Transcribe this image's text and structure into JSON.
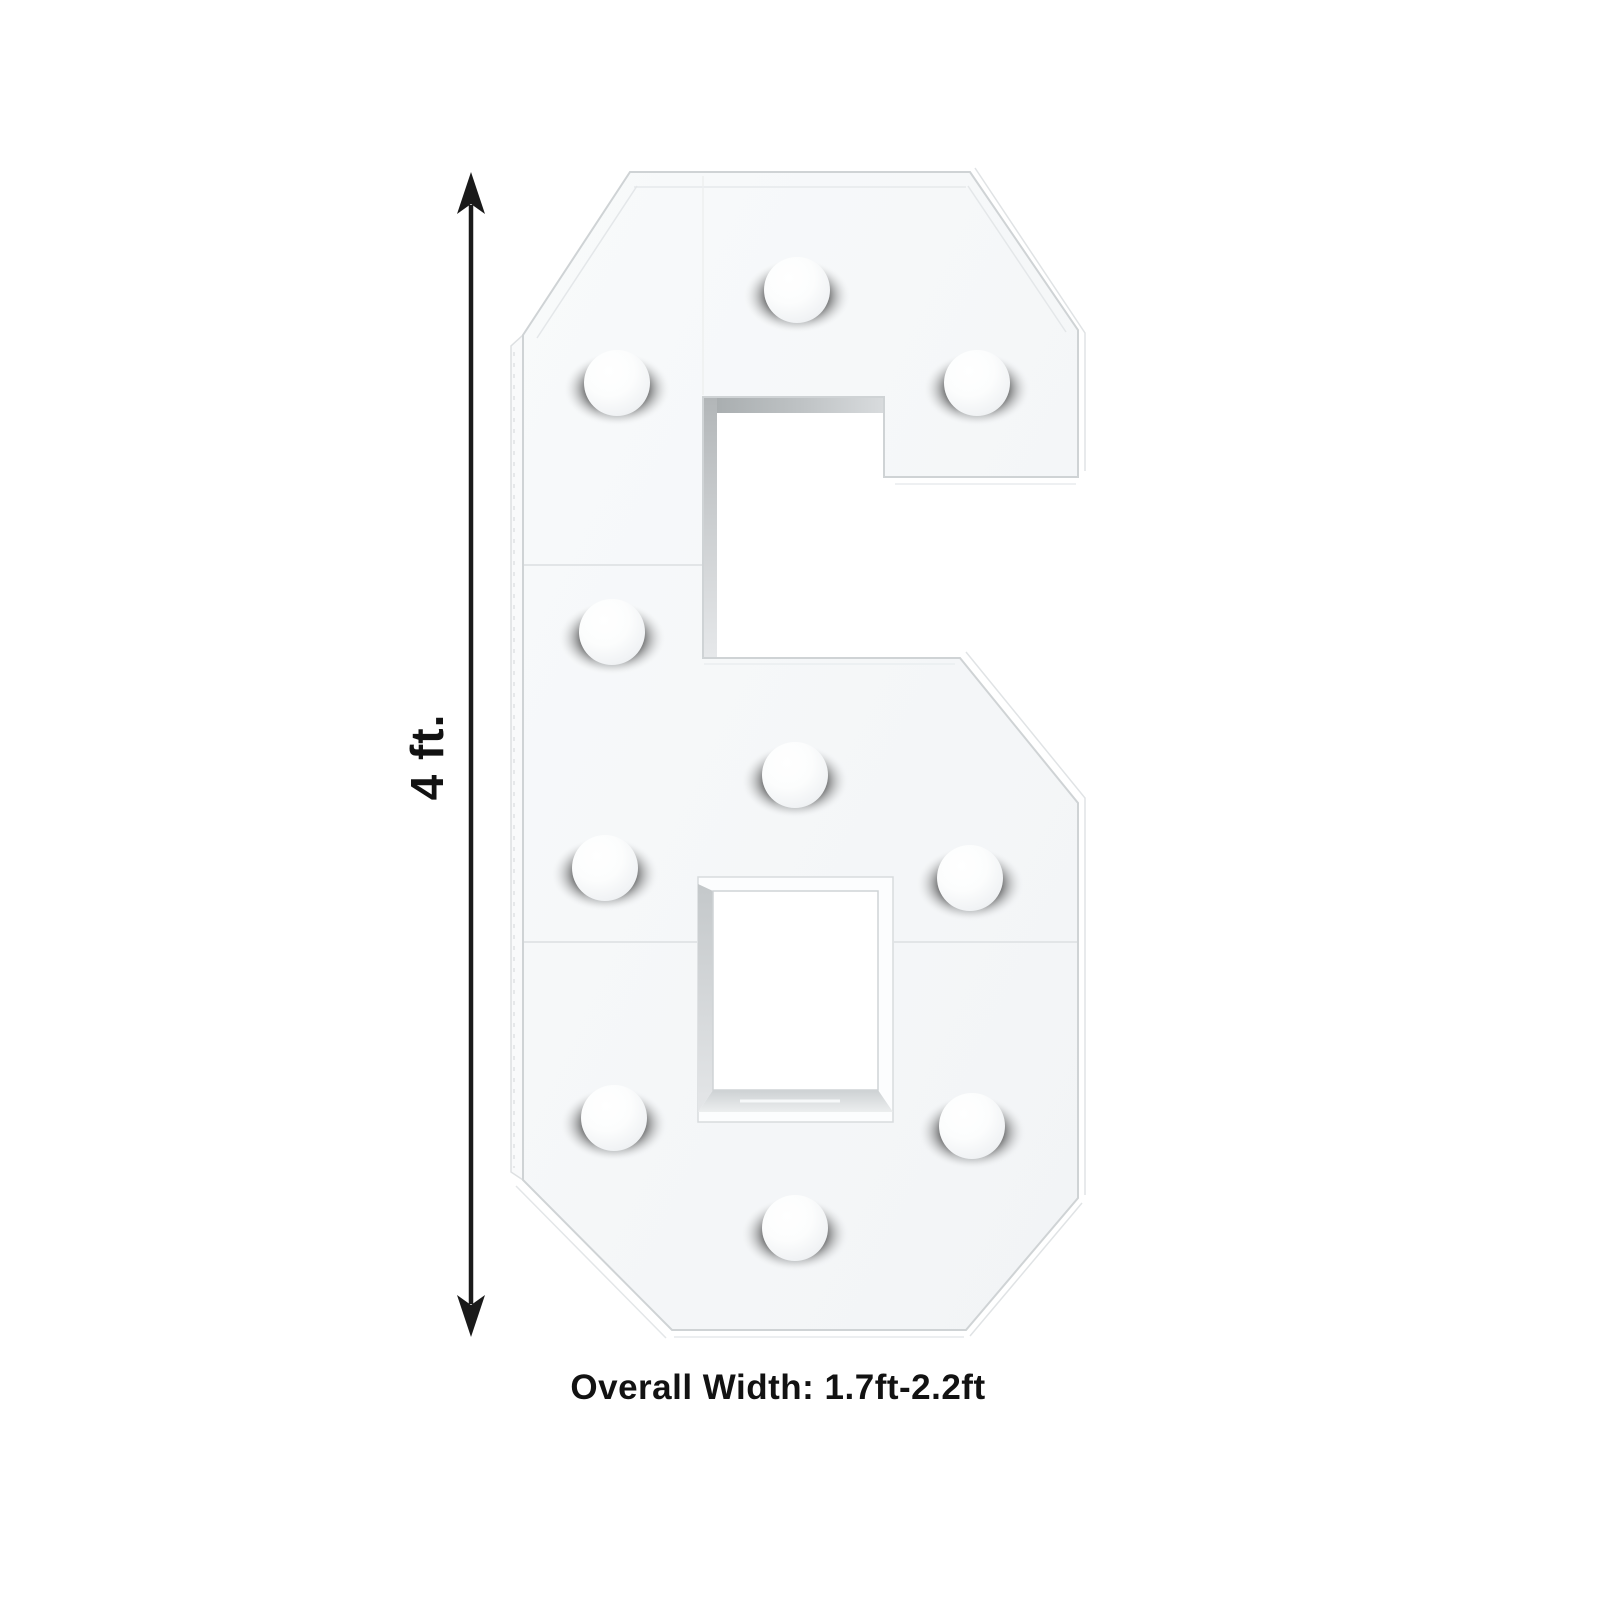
{
  "product_figure": {
    "character": "6",
    "kind": "marquee light-up number frame",
    "bulb_count": 10
  },
  "annotations": {
    "height_label": "4 ft.",
    "width_label": "Overall Width: 1.7ft-2.2ft"
  },
  "colors": {
    "background": "#ffffff",
    "panel_face": "#f5f7f8",
    "panel_edge": "#cfd3d5",
    "inner_wall": "#b0b5b7",
    "arrow": "#1a1a1a",
    "annotation_text": "#121212"
  }
}
